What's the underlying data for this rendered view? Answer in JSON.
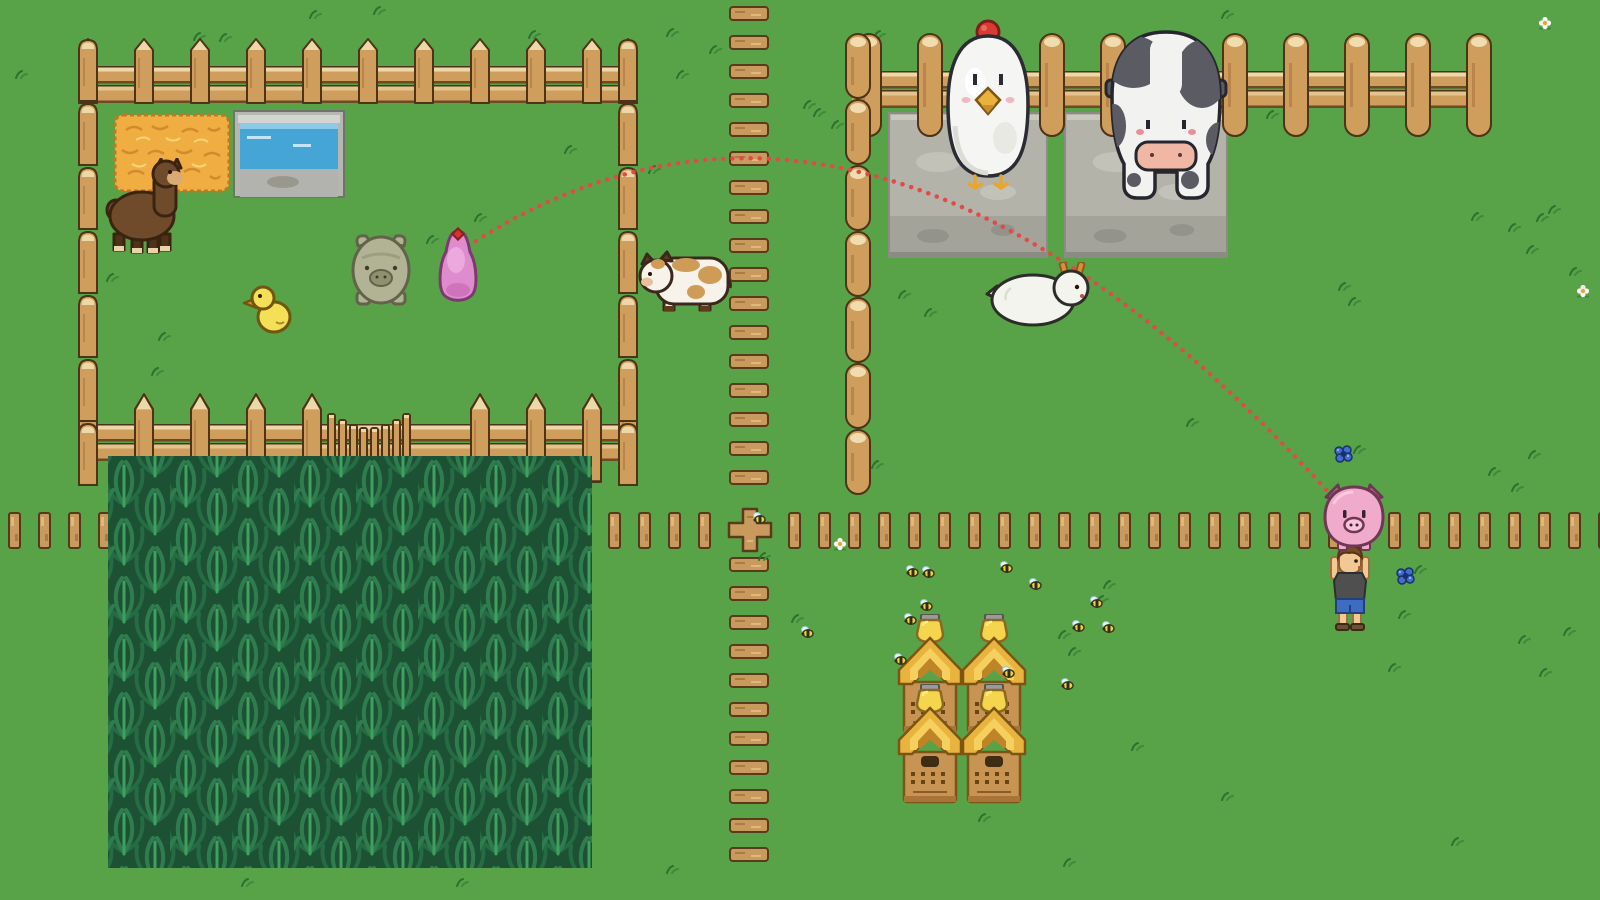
{
  "scene": {
    "name": "pixel-farm-pig-toss",
    "width": 1600,
    "height": 900,
    "grass_color": "#58a347"
  },
  "palette": {
    "grass": "#58a347",
    "grass_tuft": "#2f7030",
    "fence_wood": "#cf9e5d",
    "fence_cap": "#ecd8a8",
    "fence_outline": "#4d3317",
    "plank_wood": "#c89a5e",
    "stone": "#b3b3aa",
    "water": "#45a6d6",
    "hay": "#f0ad42",
    "corn_dark": "#1c5134",
    "corn_mid": "#2f7d4e",
    "corn_light": "#3fa05f",
    "arc_red": "#e04b48",
    "pig_pink": "#f0aacb",
    "blob_pink": "#df8cce",
    "cow_gray": "#5b5b63",
    "chicken_white": "#f5f5f3",
    "hive_gold": "#e9b43e"
  },
  "trajectory": {
    "path": "M468 246 Q868 -14 1332 496",
    "color": "#e04b48",
    "marker": {
      "x": 450,
      "y": 226
    }
  },
  "corn_field": {
    "x": 108,
    "y": 456,
    "width": 484,
    "height": 412
  },
  "fences": {
    "pen": {
      "post_xs": [
        78,
        134,
        190,
        246,
        302,
        358,
        414,
        470,
        526,
        582,
        618
      ],
      "top_post_y": 38,
      "top_rail": {
        "x": 80,
        "y": 66,
        "w": 556
      },
      "bottom_post_y": 393,
      "bottom_rail": {
        "x": 80,
        "y": 424,
        "w": 556
      },
      "bottom_skip": [
        358,
        414
      ],
      "gate": {
        "x": 327,
        "y": 400,
        "w": 84,
        "h": 92
      },
      "left_col_x": 78,
      "right_col_x": 618,
      "col_y0": 38,
      "col_segs": 7
    },
    "log": {
      "post_xs": [
        856,
        917,
        978,
        1039,
        1100,
        1161,
        1222,
        1283,
        1344,
        1405,
        1466
      ],
      "post_y": 33,
      "rail": {
        "x": 852,
        "y": 71,
        "w": 626
      },
      "column": {
        "x": 845,
        "y0": 33,
        "segs": 7
      }
    },
    "plank_row": {
      "y": 512,
      "step": 30,
      "ranges": [
        [
          8,
          98
        ],
        [
          608,
          698
        ],
        [
          788,
          1598
        ]
      ]
    },
    "path_planks": {
      "x": 729,
      "y0": 6,
      "y1": 872,
      "step": 29,
      "skip": [
        493,
        555
      ]
    },
    "cross": {
      "x": 726,
      "y": 506
    }
  },
  "entities": [
    {
      "sprite": "hay",
      "name": "hay-bale",
      "x": 112,
      "y": 112,
      "w": 120,
      "h": 82,
      "z": 1,
      "interactable": false
    },
    {
      "sprite": "trough",
      "name": "water-trough",
      "x": 233,
      "y": 110,
      "w": 112,
      "h": 90,
      "z": 1,
      "interactable": false
    },
    {
      "sprite": "platform",
      "name": "stone-platform-chicken",
      "x": 888,
      "y": 112,
      "w": 160,
      "h": 146,
      "z": 1,
      "interactable": false
    },
    {
      "sprite": "platform",
      "name": "stone-platform-cow",
      "x": 1064,
      "y": 112,
      "w": 164,
      "h": 146,
      "z": 1,
      "interactable": false
    },
    {
      "sprite": "smallcow",
      "name": "spotted-cow",
      "x": 634,
      "y": 248,
      "w": 100,
      "h": 70,
      "z": 1,
      "interactable": true
    },
    {
      "sprite": "alpaca",
      "name": "alpaca",
      "x": 100,
      "y": 158,
      "w": 100,
      "h": 98,
      "z": 5,
      "interactable": true
    },
    {
      "sprite": "duck",
      "name": "duckling",
      "x": 242,
      "y": 280,
      "w": 54,
      "h": 55,
      "z": 5,
      "interactable": true
    },
    {
      "sprite": "greenpig",
      "name": "green-pig",
      "x": 350,
      "y": 228,
      "w": 62,
      "h": 78,
      "z": 5,
      "interactable": true
    },
    {
      "sprite": "pinkblob",
      "name": "pink-pig-blob",
      "x": 432,
      "y": 228,
      "w": 52,
      "h": 76,
      "z": 5,
      "interactable": true
    },
    {
      "sprite": "diamond",
      "name": "target-marker",
      "x": 450,
      "y": 226,
      "w": 16,
      "h": 16,
      "z": 6,
      "interactable": false
    },
    {
      "sprite": "bigchicken",
      "name": "giant-chicken",
      "x": 933,
      "y": 16,
      "w": 110,
      "h": 182,
      "z": 5,
      "interactable": true
    },
    {
      "sprite": "bigcow",
      "name": "giant-cow",
      "x": 1098,
      "y": 28,
      "w": 136,
      "h": 174,
      "z": 5,
      "interactable": true
    },
    {
      "sprite": "goat",
      "name": "goat",
      "x": 985,
      "y": 262,
      "w": 108,
      "h": 66,
      "z": 5,
      "interactable": true
    },
    {
      "sprite": "hive",
      "name": "beehive",
      "x": 897,
      "y": 614,
      "w": 66,
      "h": 122,
      "z": 5,
      "interactable": true
    },
    {
      "sprite": "hive",
      "name": "beehive",
      "x": 961,
      "y": 614,
      "w": 66,
      "h": 122,
      "z": 5,
      "interactable": true
    },
    {
      "sprite": "hive",
      "name": "beehive",
      "x": 897,
      "y": 684,
      "w": 66,
      "h": 122,
      "z": 5,
      "interactable": true
    },
    {
      "sprite": "hive",
      "name": "beehive",
      "x": 961,
      "y": 684,
      "w": 66,
      "h": 122,
      "z": 5,
      "interactable": true
    },
    {
      "sprite": "farmer",
      "name": "farmer-character",
      "x": 1330,
      "y": 543,
      "w": 40,
      "h": 88,
      "z": 6,
      "interactable": true
    },
    {
      "sprite": "heldpig",
      "name": "held-pig",
      "x": 1320,
      "y": 483,
      "w": 68,
      "h": 68,
      "z": 7,
      "interactable": true
    }
  ],
  "bees": [
    [
      905,
      565
    ],
    [
      921,
      566
    ],
    [
      999,
      561
    ],
    [
      1028,
      578
    ],
    [
      919,
      599
    ],
    [
      903,
      613
    ],
    [
      1089,
      596
    ],
    [
      1071,
      620
    ],
    [
      1101,
      621
    ],
    [
      893,
      653
    ],
    [
      1001,
      666
    ],
    [
      1060,
      678
    ],
    [
      800,
      626
    ],
    [
      752,
      512
    ]
  ],
  "flowers_blue": [
    [
      1332,
      444
    ],
    [
      1394,
      566
    ]
  ],
  "flowers_white": [
    [
      1576,
      284
    ],
    [
      833,
      537
    ],
    [
      1538,
      16
    ]
  ],
  "grass_tufts": [
    [
      192,
      32
    ],
    [
      218,
      33
    ],
    [
      308,
      10
    ],
    [
      372,
      6
    ],
    [
      527,
      30
    ],
    [
      563,
      145
    ],
    [
      473,
      213
    ],
    [
      425,
      235
    ],
    [
      105,
      273
    ],
    [
      157,
      332
    ],
    [
      150,
      367
    ],
    [
      14,
      70
    ],
    [
      872,
      30
    ],
    [
      1220,
      10
    ],
    [
      1265,
      110
    ],
    [
      897,
      290
    ],
    [
      923,
      308
    ],
    [
      1337,
      282
    ],
    [
      1347,
      297
    ],
    [
      1352,
      445
    ],
    [
      1487,
      467
    ],
    [
      1510,
      483
    ],
    [
      1527,
      450
    ],
    [
      1413,
      565
    ],
    [
      1397,
      610
    ],
    [
      1517,
      635
    ],
    [
      1562,
      627
    ],
    [
      1387,
      663
    ],
    [
      1538,
      668
    ],
    [
      665,
      28
    ],
    [
      708,
      45
    ],
    [
      675,
      70
    ],
    [
      802,
      100
    ],
    [
      812,
      108
    ],
    [
      830,
      120
    ],
    [
      647,
      165
    ],
    [
      1470,
      212
    ],
    [
      1507,
      223
    ],
    [
      1535,
      213
    ],
    [
      1547,
      205
    ],
    [
      1525,
      245
    ],
    [
      1568,
      267
    ],
    [
      757,
      552
    ],
    [
      665,
      865
    ],
    [
      1102,
      580
    ],
    [
      1095,
      595
    ],
    [
      1057,
      630
    ],
    [
      1067,
      647
    ],
    [
      790,
      614
    ],
    [
      977,
      813
    ],
    [
      1220,
      792
    ],
    [
      1450,
      837
    ],
    [
      1062,
      858
    ],
    [
      455,
      878
    ],
    [
      240,
      878
    ],
    [
      1130,
      742
    ],
    [
      870,
      460
    ],
    [
      1185,
      418
    ]
  ]
}
